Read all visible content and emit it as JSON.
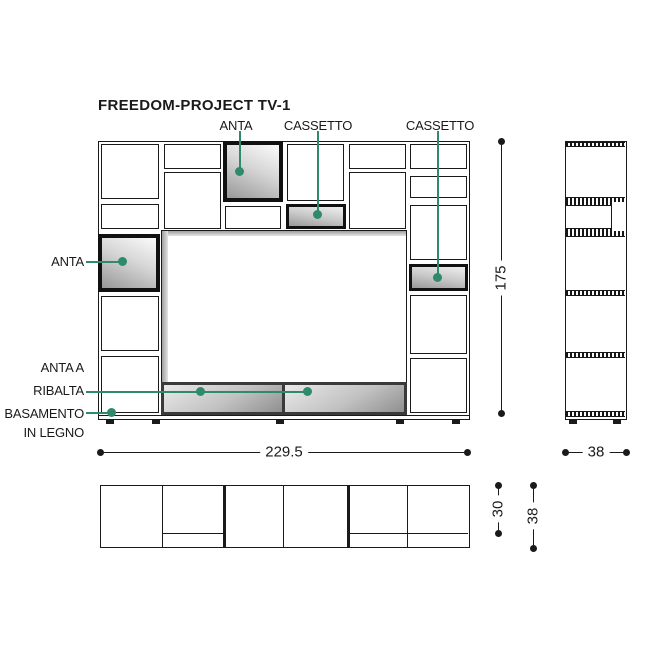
{
  "title": "FREEDOM-PROJECT TV-1",
  "front_view": {
    "labels": {
      "anta_top": "ANTA",
      "cassetto_top": "CASSETTO",
      "cassetto_right": "CASSETTO",
      "anta_left": "ANTA",
      "anta_ribalta_line1": "ANTA A",
      "anta_ribalta_line2": "RIBALTA",
      "basamento_line1": "BASAMENTO",
      "basamento_line2": "IN LEGNO"
    },
    "dimensions": {
      "width": "229.5",
      "height": "175"
    }
  },
  "side_view": {
    "dimensions": {
      "depth": "38"
    }
  },
  "plan_view": {
    "dimensions": {
      "shelf_depth": "30",
      "base_depth": "38"
    }
  },
  "colors": {
    "leader_green": "#2E8A6B",
    "line_black": "#1a1a1a"
  }
}
